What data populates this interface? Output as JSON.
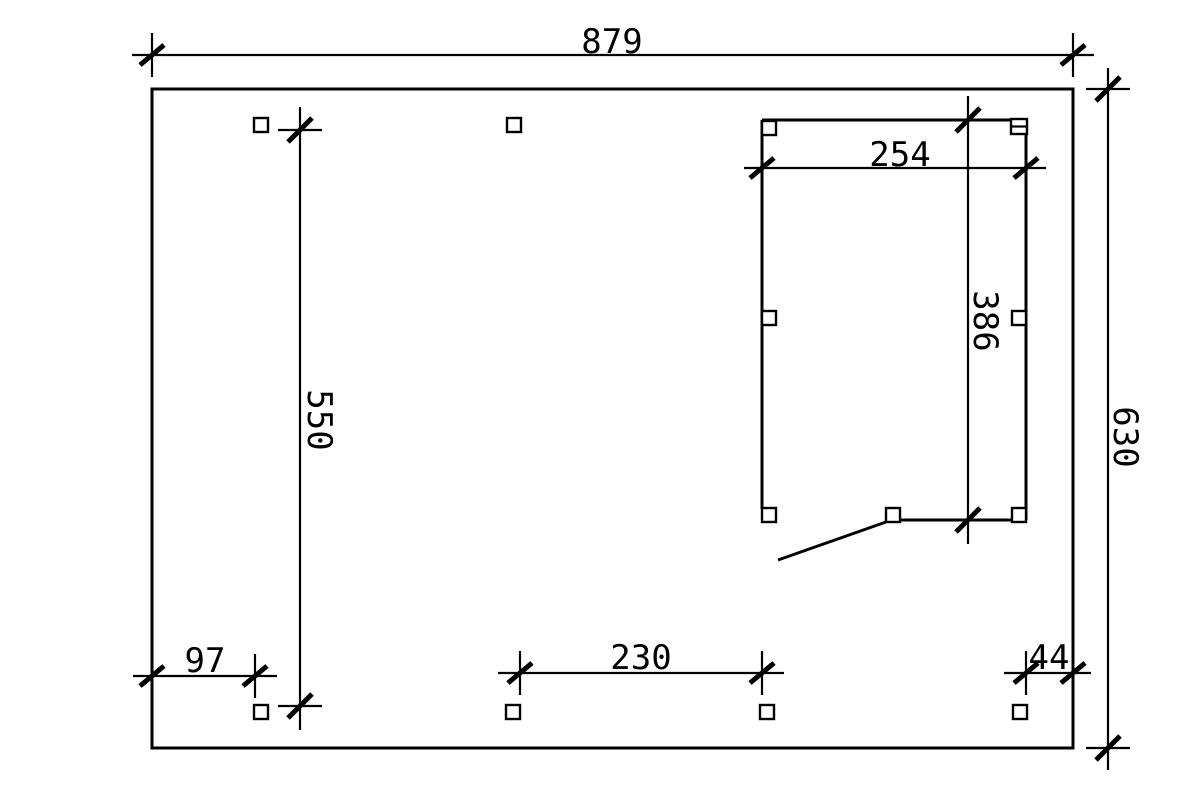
{
  "drawing": {
    "background_color": "#ffffff",
    "line_color": "#000000",
    "dimensions": {
      "overall_width": "879",
      "overall_height": "630",
      "post_row_span": "550",
      "shed_width": "254",
      "shed_depth": "386",
      "left_post_offset": "97",
      "front_post_spacing": "230",
      "right_post_offset": "44"
    }
  }
}
